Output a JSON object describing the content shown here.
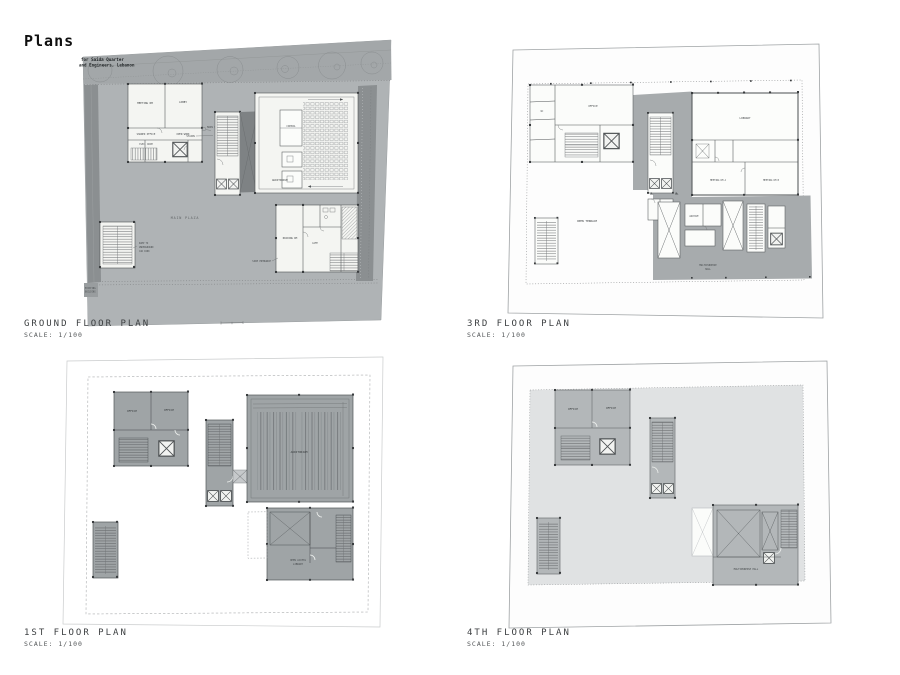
{
  "sheet": {
    "title": "Plans"
  },
  "plans": {
    "ground": {
      "title": "GROUND FLOOR PLAN",
      "scale": "SCALE: 1/100",
      "titleblock": {
        "line1": "for Saida Quarter",
        "line2": "and Engineers, Lebanon"
      },
      "labels": {
        "meeting": "MEETING RM",
        "lobby": "LOBBY",
        "shared": "SHARED OFFICE",
        "open": "OPEN WORK",
        "elec": "ELEC. ROOM",
        "control": "CONTROL",
        "auditorium": "AUDITORIUM",
        "reading": "READING RM",
        "cafe": "CAFE",
        "stairs": "STAIRS",
        "entrance": "MAIN ENTRANCE",
        "entrance2": "SIDE ENTRANCE",
        "plaza": "MAIN PLAZA",
        "ramp1": "RAMP TO",
        "ramp2": "UNDERGROUND",
        "ramp3": "CAR PARK",
        "existing1": "EXISTING",
        "existing2": "BUILDING"
      }
    },
    "third": {
      "title": "3RD FLOOR PLAN",
      "scale": "SCALE: 1/100",
      "labels": {
        "office": "OFFICE",
        "library": "LIBRARY",
        "meetA": "MEETING RM A",
        "meetB": "MEETING RM B",
        "archive": "ARCHIVE",
        "wc": "WC",
        "terrace": "OPEN TERRACE",
        "hall1": "MULTIPURPOSE",
        "hall2": "HALL"
      }
    },
    "first": {
      "title": "1ST FLOOR PLAN",
      "scale": "SCALE: 1/100",
      "labels": {
        "officeA": "OFFICE",
        "officeB": "OFFICE",
        "auditorium": "AUDITORIUM",
        "lib1": "OPEN ACCESS",
        "lib2": "LIBRARY"
      }
    },
    "fourth": {
      "title": "4TH FLOOR PLAN",
      "scale": "SCALE: 1/100",
      "labels": {
        "officeA": "OFFICE",
        "officeB": "OFFICE",
        "hall": "MULTIPURPOSE HALL"
      }
    }
  }
}
